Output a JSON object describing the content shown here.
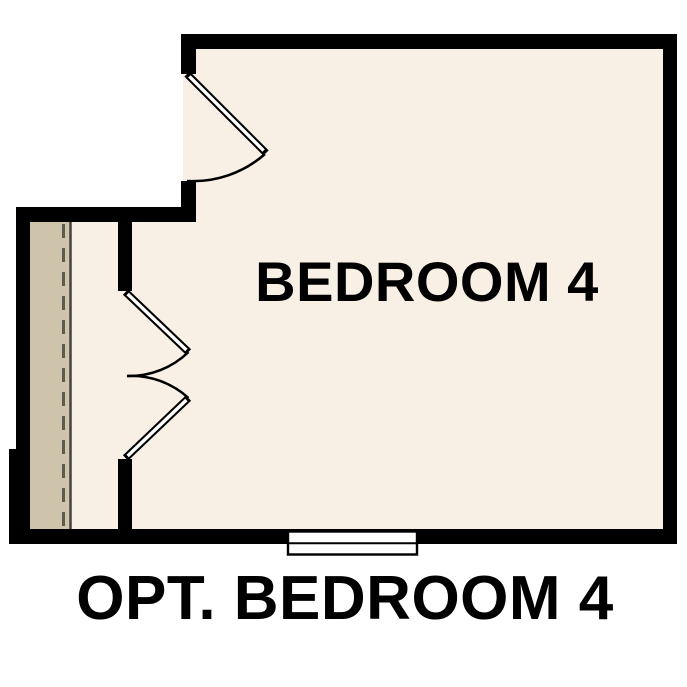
{
  "plan": {
    "room_label": "BEDROOM 4",
    "caption": "OPT. BEDROOM 4"
  },
  "colors": {
    "page_background": "#ffffff",
    "wall": "#000000",
    "room_fill": "#f8f0e5",
    "closet_fill": "#cec3ab",
    "rod_line": "#5f5b4a",
    "shelf_line": "#45433a",
    "door_stroke": "#000000",
    "door_fill": "#ffffff",
    "window_fill": "#ffffff",
    "label_color": "#000000"
  }
}
